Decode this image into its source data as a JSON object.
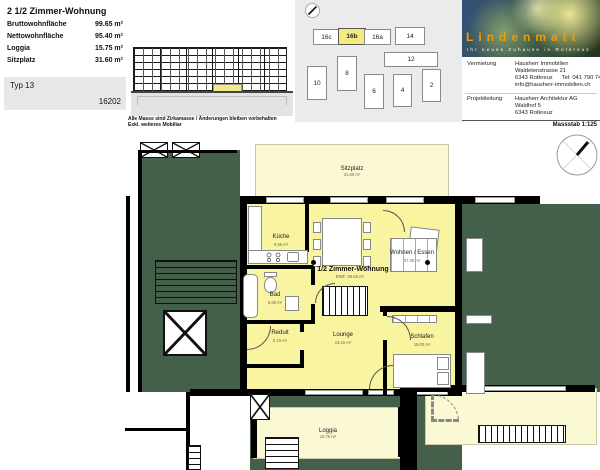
{
  "header": {
    "title": "2 1/2 Zimmer-Wohnung",
    "stats": [
      {
        "label": "Bruttowohnfläche",
        "value": "99.65 m²"
      },
      {
        "label": "Nettowohnfläche",
        "value": "95.40 m²"
      },
      {
        "label": "Loggia",
        "value": "15.75 m²"
      },
      {
        "label": "Sitzplatz",
        "value": "31.60 m²"
      }
    ],
    "type_label": "Typ 13",
    "unit_number": "16202"
  },
  "elevation": {
    "caption_line1": "Alle Masse sind Zirkamasse / Änderungen bleiben vorbehalten",
    "caption_line2": "Exkl. weiteres Mobiliar"
  },
  "siteplan": {
    "buildings": [
      {
        "label": "16c"
      },
      {
        "label": "16b"
      },
      {
        "label": "16a"
      },
      {
        "label": "14"
      },
      {
        "label": "12"
      },
      {
        "label": "10"
      },
      {
        "label": "8"
      },
      {
        "label": "6"
      },
      {
        "label": "4"
      },
      {
        "label": "2"
      }
    ],
    "highlighted": "16b"
  },
  "brand": {
    "name": "Lindenmatt",
    "tagline": "Ihr neues Zuhause in Rotkreuz",
    "accent_color": "#f29b00"
  },
  "contacts": {
    "vermietung": {
      "label": "Vermietung",
      "company": "Hausherr Immobilien",
      "street": "Waldetenstrasse 21",
      "city": "6343 Rotkreuz",
      "tel": "Tel: 041 790 74 00",
      "email": "info@hausherr-immobilien.ch"
    },
    "projektleitung": {
      "label": "Projektleitung",
      "company": "Hausherr Architektur AG",
      "street": "Waldhof 5",
      "city": "6343 Rotkreuz"
    }
  },
  "scale_label": "Massstab 1:125",
  "plan": {
    "apartment_label": "2 1/2 Zimmer-Wohnung",
    "apartment_area": "BWF: 99.65 m²",
    "rooms": [
      {
        "name": "Sitzplatz",
        "area": "31.60 m²"
      },
      {
        "name": "Küche",
        "area": "9.95 m²"
      },
      {
        "name": "Wohnen / Essen",
        "area": "37.30 m²"
      },
      {
        "name": "Bad",
        "area": "5.85 m²"
      },
      {
        "name": "Reduit",
        "area": "5.10 m²"
      },
      {
        "name": "Lounge",
        "area": "19.15 m²"
      },
      {
        "name": "Schlafen",
        "area": "18.00 m²"
      },
      {
        "name": "Loggia",
        "area": "15.75 m²"
      }
    ],
    "colors": {
      "apartment": "#f8f4a0",
      "outdoor": "#fbf8d4",
      "other_units": "#44604a",
      "highlight": "#f2ea86"
    }
  }
}
